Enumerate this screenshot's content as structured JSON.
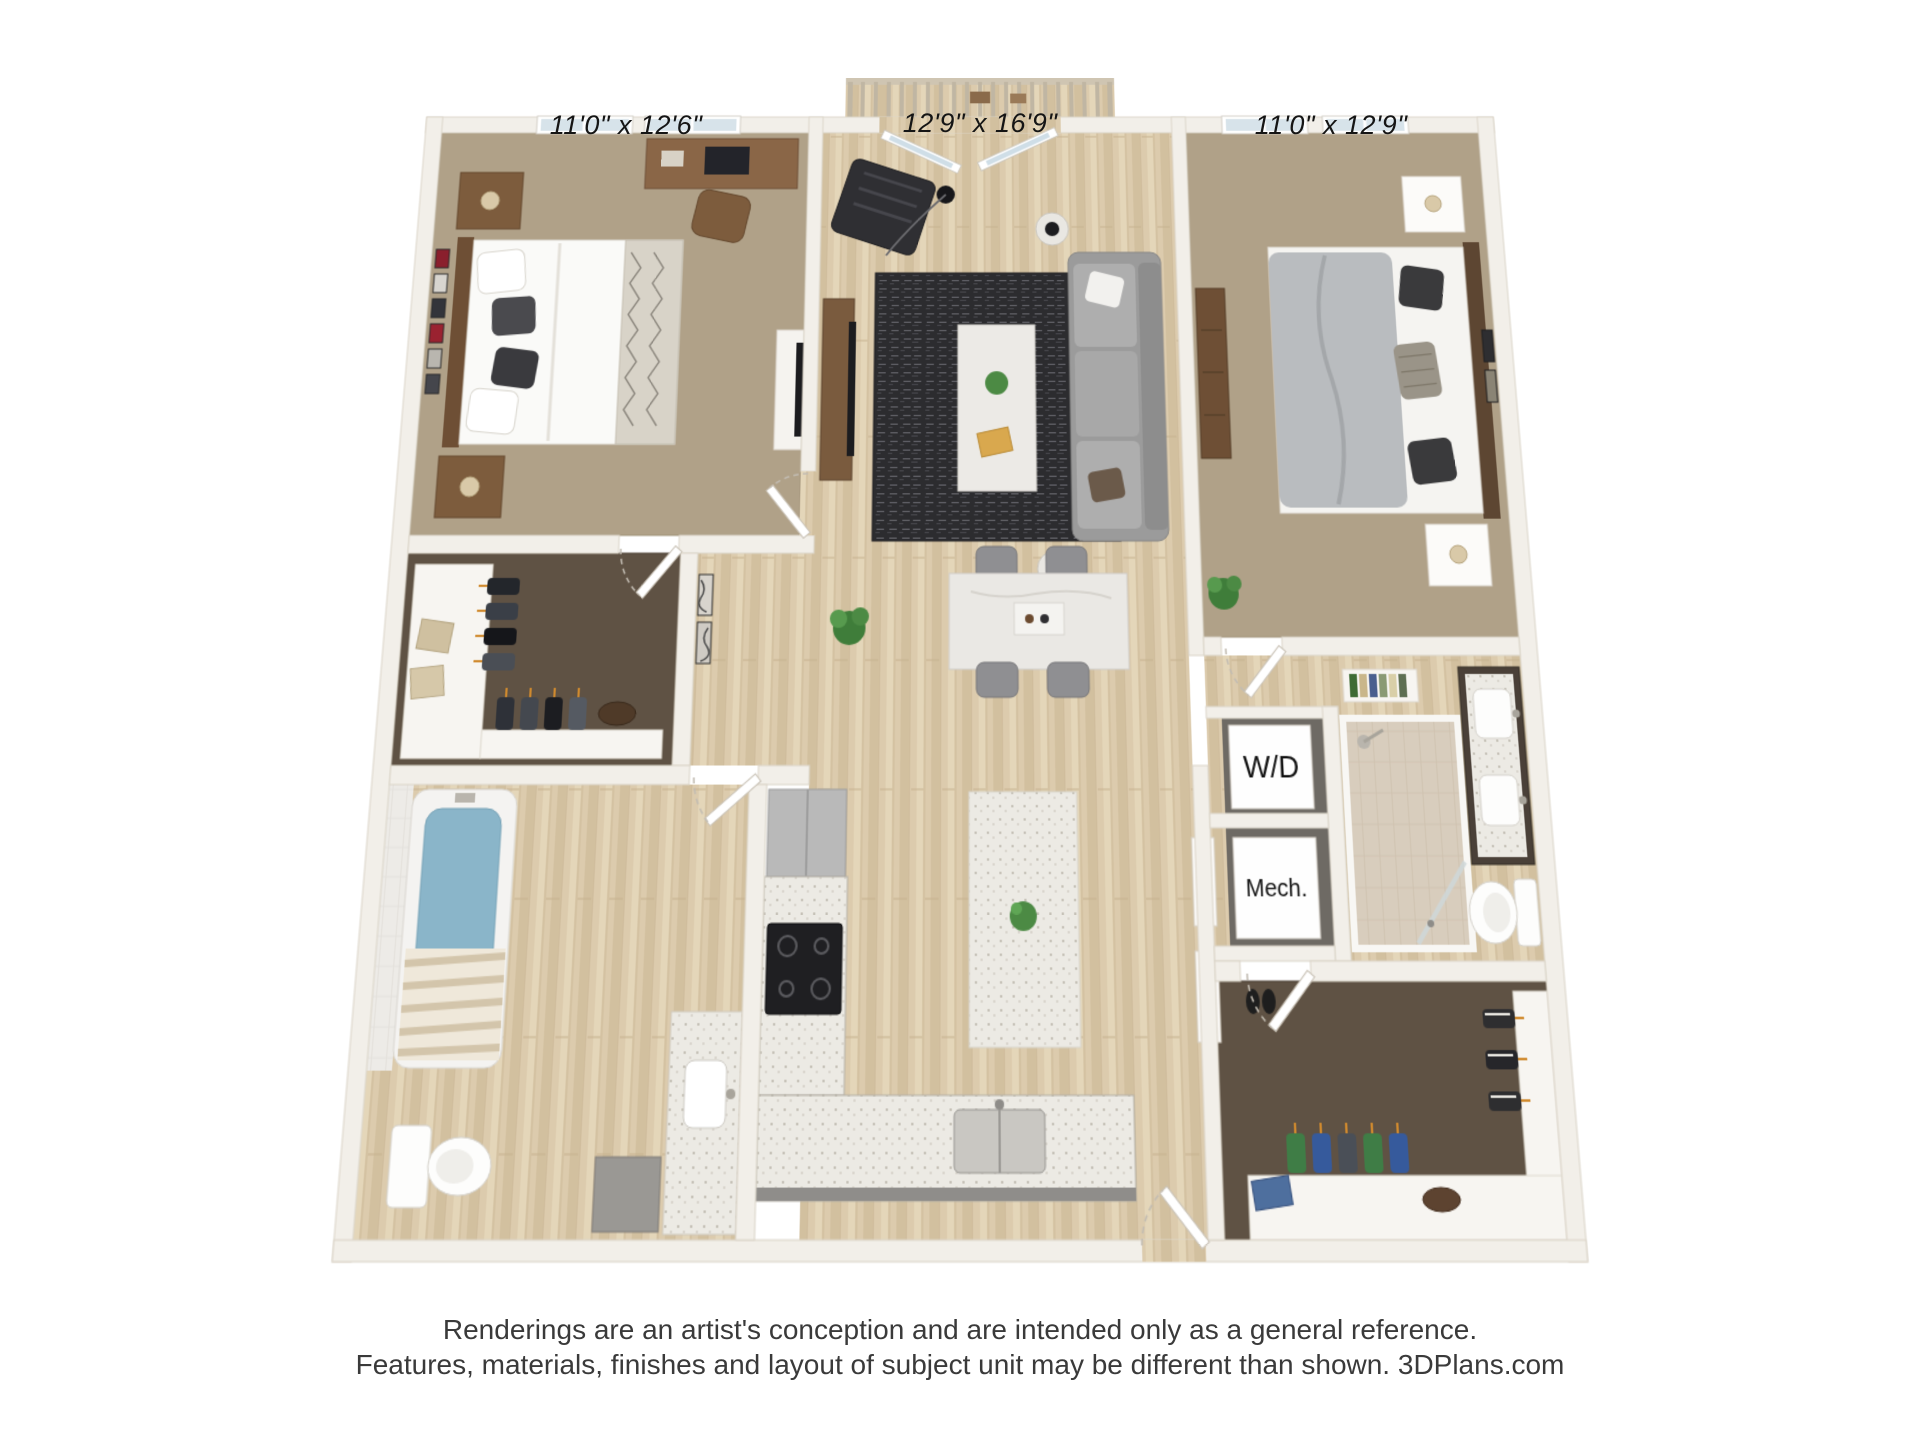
{
  "floorplan": {
    "labels": {
      "bedroom1": "11'0\" x 12'6\"",
      "living": "12'9\" x 16'9\"",
      "bedroom2": "11'0\" x 12'9\""
    },
    "utility": {
      "washer_dryer": "W/D",
      "mechanical": "Mech."
    }
  },
  "disclaimer": {
    "line1": "Renderings are an artist's conception and are intended only as a general reference.",
    "line2": "Features, materials, finishes and layout of subject unit may be different than shown. 3DPlans.com"
  },
  "colors": {
    "wall": "#f2efe9",
    "carpet": "#b0a188",
    "dark_carpet": "#5f5244",
    "wood_floor": "#dccbad",
    "rug": "#2c2c2f",
    "tub_water": "#8ab5c9",
    "counter_gray": "#8f8d8a",
    "text": "#151515"
  }
}
